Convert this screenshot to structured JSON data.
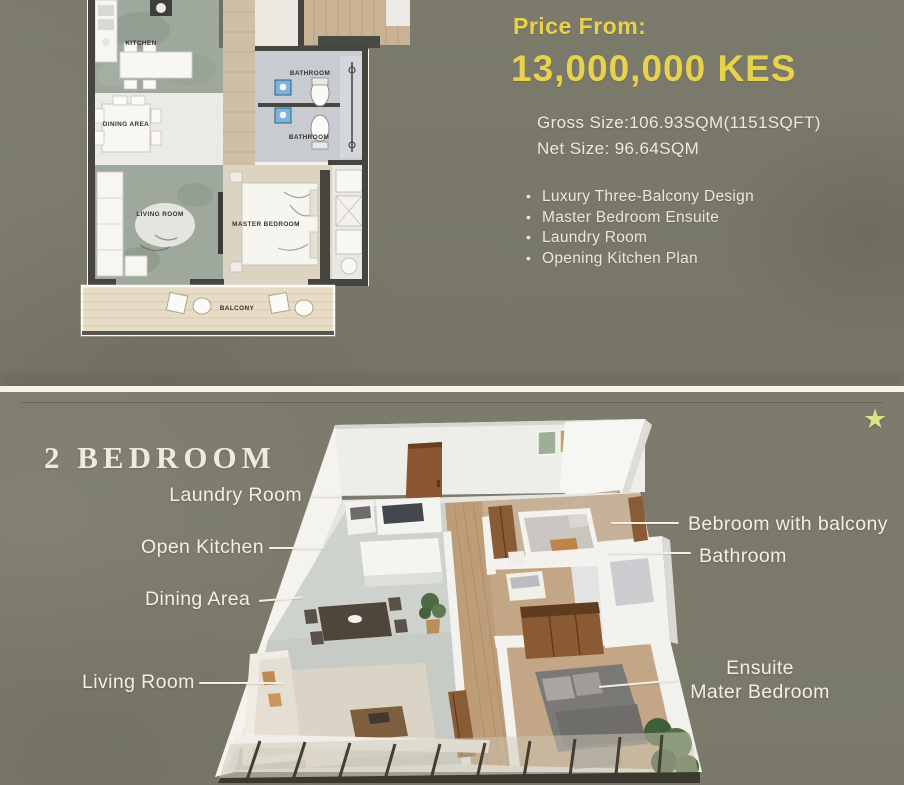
{
  "colors": {
    "background": "#7b7a6c",
    "accent_yellow": "#e8d24c",
    "text_light": "#f3f0e3",
    "star": "#dbe287"
  },
  "top": {
    "price_label": "Price From:",
    "price_value": "13,000,000 KES",
    "gross_size": "Gross Size:106.93SQM(1151SQFT)",
    "net_size": "Net Size: 96.64SQM",
    "bullet_char": "•",
    "features": [
      "Luxury Three-Balcony Design",
      "Master Bedroom Ensuite",
      "Laundry Room",
      "Opening Kitchen Plan"
    ],
    "plan_rooms": [
      "KITCHEN",
      "DINING AREA",
      "BATHROOM",
      "BATHROOM",
      "LIVING ROOM",
      "MASTER BEDROOM",
      "BALCONY"
    ]
  },
  "bottom": {
    "title": "2 BEDROOM",
    "star_icon": "★",
    "callouts": {
      "laundry": "Laundry Room",
      "kitchen": "Open Kitchen",
      "dining": "Dining Area",
      "living": "Living Room",
      "bedroom_balcony": "Bebroom with balcony",
      "bathroom": "Bathroom",
      "ensuite_line1": "Ensuite",
      "ensuite_line2": "Mater Bedroom"
    }
  }
}
